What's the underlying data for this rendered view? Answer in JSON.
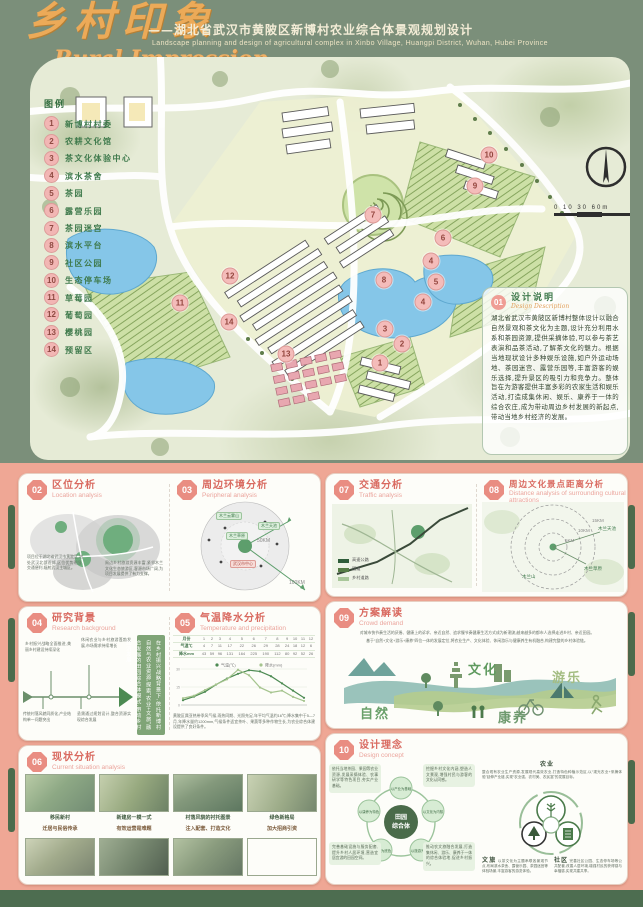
{
  "header": {
    "title_cn": "乡村印象",
    "subtitle_cn": "——湖北省武汉市黄陂区新博村农业综合体景观规划设计",
    "subtitle_en": "Landscape planning and design of agricultural complex in Xinbo Village, Huangpi District, Wuhan, Hubei Province",
    "title_en": "Rural Impression"
  },
  "map": {
    "legend_title": "图例",
    "legend_items": [
      {
        "num": "1",
        "label": "新博村村委"
      },
      {
        "num": "2",
        "label": "农耕文化馆"
      },
      {
        "num": "3",
        "label": "茶文化体验中心"
      },
      {
        "num": "4",
        "label": "滨水茶舍"
      },
      {
        "num": "5",
        "label": "茶园"
      },
      {
        "num": "6",
        "label": "露营乐园"
      },
      {
        "num": "7",
        "label": "茶园迷宫"
      },
      {
        "num": "8",
        "label": "滨水平台"
      },
      {
        "num": "9",
        "label": "社区公园"
      },
      {
        "num": "10",
        "label": "生态停车场"
      },
      {
        "num": "11",
        "label": "草莓园"
      },
      {
        "num": "12",
        "label": "葡萄园"
      },
      {
        "num": "13",
        "label": "樱桃园"
      },
      {
        "num": "14",
        "label": "预留区"
      }
    ],
    "markers": [
      {
        "num": "1",
        "x": 350,
        "y": 306
      },
      {
        "num": "2",
        "x": 372,
        "y": 287
      },
      {
        "num": "3",
        "x": 355,
        "y": 272
      },
      {
        "num": "4",
        "x": 401,
        "y": 204
      },
      {
        "num": "4",
        "x": 393,
        "y": 245
      },
      {
        "num": "5",
        "x": 406,
        "y": 225
      },
      {
        "num": "6",
        "x": 413,
        "y": 181
      },
      {
        "num": "7",
        "x": 343,
        "y": 158
      },
      {
        "num": "8",
        "x": 354,
        "y": 223
      },
      {
        "num": "9",
        "x": 445,
        "y": 129
      },
      {
        "num": "10",
        "x": 459,
        "y": 98
      },
      {
        "num": "11",
        "x": 150,
        "y": 246
      },
      {
        "num": "12",
        "x": 200,
        "y": 219
      },
      {
        "num": "13",
        "x": 256,
        "y": 297
      },
      {
        "num": "14",
        "x": 199,
        "y": 265
      }
    ],
    "scale_text": "0 10   30         60m",
    "description": {
      "badge": "01",
      "title_cn": "设计说明",
      "title_en": "Design Description",
      "body": "湖北省武汉市黄陂区新博村整体设计以融合自然景观和茶文化为主题,设计充分利用水系和茶园资源,提供采摘体验,可以参与茶艺表演和品茶活动,了解茶文化的魅力。根据当地现状设计多种娱乐设施,如户外运动场地、茶园迷宫、露营乐园等,丰富游客的娱乐选择,提升景区的吸引力和竞争力。整体旨在为游客提供丰富多彩的农家生活和娱乐活动,打造成集休闲、娱乐、康养于一体的综合农庄,成为带动周边乡村发展的新起点,带动当地乡村经济的发展。"
    }
  },
  "panels": {
    "location": {
      "badge": "02",
      "title_cn": "区位分析",
      "title_en": "Location analysis",
      "text_a": "项目位于湖北省武汉市黄陂区,地处武汉北部近郊,区位优势明显,交通便利,辐射武汉主城区。",
      "text_b": "周边乡村旅游资源丰富,紧邻木兰文化生态旅游区,客源市场广阔,为项目发展提供了有力支撑。"
    },
    "peripheral": {
      "badge": "03",
      "title_cn": "周边环境分析",
      "title_en": "Peripheral analysis",
      "chips_green": [
        "木兰云雾山",
        "木兰天池",
        "木兰草原"
      ],
      "chip_pink": "武汉市中心",
      "ring_near": "50KM",
      "ring_far": "100KM"
    },
    "research": {
      "badge": "04",
      "title_cn": "研究背景",
      "title_en": "Research background",
      "items": [
        "乡村振兴战略全面推进,美丽乡村建设持续深化",
        "休闲农业与乡村旅游蓬勃发展,市场需求持续增长",
        "传统村落风貌同质化,产业结构单一问题突出",
        "亟需通过规划设计,整合资源实现综合发展"
      ],
      "sidebar_text": "在乡村振兴战略背景下,依托新博村自然与农业资源,探索“农业+文旅”融合发展的田园综合体模式,带动乡村经济发展。"
    },
    "climate": {
      "badge": "05",
      "title_cn": "气温降水分析",
      "title_en": "Temperature and precipitation",
      "row_month": "月份",
      "row_temp": "气温℃",
      "row_precip": "降水mm",
      "note": "黄陂区属亚热带季风气候,雨热同期、光照充足,年平均气温约16℃;降水集中于5—7月,年降水量约1200mm,气候条件适宜茶叶、果蔬等多种作物生长,为农业综合体建设提供了良好条件。"
    },
    "current": {
      "badge": "06",
      "title_cn": "现状分析",
      "title_en": "Current situation analysis",
      "captions_top": [
        "移民新村",
        "新建房一模一式",
        "村落风貌的衬托图景",
        "绿色新格局"
      ],
      "captions_bottom": [
        "迁居与民俗传承",
        "有效运营是难题",
        "注入配套、打造文化",
        "加大招商引资"
      ]
    },
    "traffic": {
      "badge": "07",
      "title_cn": "交通分析",
      "title_en": "Traffic analysis",
      "legend": [
        {
          "color": "#2f5d3a",
          "label": "高速公路"
        },
        {
          "color": "#567d46",
          "label": "国道"
        },
        {
          "color": "#a9c79a",
          "label": "乡村道路"
        }
      ]
    },
    "distance": {
      "badge": "08",
      "title_cn": "周边文化景点距离分析",
      "title_en": "Distance analysis of surrounding cultural attractions",
      "rings": [
        "5KM",
        "10KM",
        "15KM"
      ],
      "pois": [
        "木兰天池",
        "木兰草原",
        "木兰山"
      ]
    },
    "demand": {
      "badge": "09",
      "title_cn": "方案解读",
      "title_en": "Crowd demand",
      "line1": "对城市快节奏生活的厌倦、健康上的诉求、亲近自然、追求慢节奏健康生活方式成为新潮流,越来越多的都市人选择走进乡村、亲近田园。",
      "line2": "基于“自然+文化+游乐+康养”四位一体的发展定位,将农业生产、文化体验、休闲游乐与健康养生有机融合,构建完整的乡村体验链。",
      "labels": {
        "nature": "自然",
        "culture": "文化",
        "play": "游乐",
        "wellness": "康养"
      }
    },
    "concept": {
      "badge": "10",
      "title_cn": "设计理念",
      "title_en": "Design concept",
      "center_line1": "田园",
      "center_line2": "综合体",
      "nodes": [
        "以产业为基础",
        "以文化为内核",
        "以旅游为抓手",
        "以生态为底色",
        "以康养为特色"
      ],
      "corners": [
        "依托当地茶园、果园等农业资源,发展采摘体验、农事研学等特色项目,夯实产业基础。",
        "挖掘乡村文化内涵,塑造人文景观,增强村民与游客的文化认同感。",
        "完善基础设施与服务配套,提升乡村人居环境,营造宜居宜游的田园空间。",
        "推动农文旅融合发展,打造集休闲、游乐、康养于一体的综合体验地,促进乡村振兴。"
      ],
      "trefoil": {
        "top_label": "农业",
        "left_label": "文旅",
        "right_label": "社区",
        "top_text": "整合现有农业生产资源,发展现代高效农业,打造特色种植示范区,以“观光农业+采摘体验”延伸产业链,实现“农业强、农村美、农民富”的发展目标。",
        "left_text": "以茶文化为主题串联各景观节点,布局滨水茶舍、露营乐园、茶园迷宫等体验场景,丰富游客的游览体验。",
        "right_text": "完善社区公园、生态停车场等公共配套,改善人居环境,增强村民的获得感与幸福感,实现共建共享。"
      }
    }
  },
  "chart_data": {
    "type": "line",
    "title": "气温降水分析",
    "categories": [
      "1",
      "2",
      "3",
      "4",
      "5",
      "6",
      "7",
      "8",
      "9",
      "10",
      "11",
      "12"
    ],
    "series": [
      {
        "name": "气温(℃)",
        "color": "#4c8a52",
        "values": [
          4,
          7,
          11,
          17,
          22,
          26,
          29,
          28,
          24,
          18,
          12,
          6
        ]
      },
      {
        "name": "降水(mm)",
        "color": "#a5c48e",
        "values": [
          43,
          59,
          96,
          131,
          164,
          225,
          190,
          112,
          80,
          92,
          52,
          26
        ]
      }
    ],
    "xlabel": "月份",
    "ylabel": "",
    "ylim": [
      0,
      30
    ],
    "grid": true,
    "legend_position": "top"
  }
}
